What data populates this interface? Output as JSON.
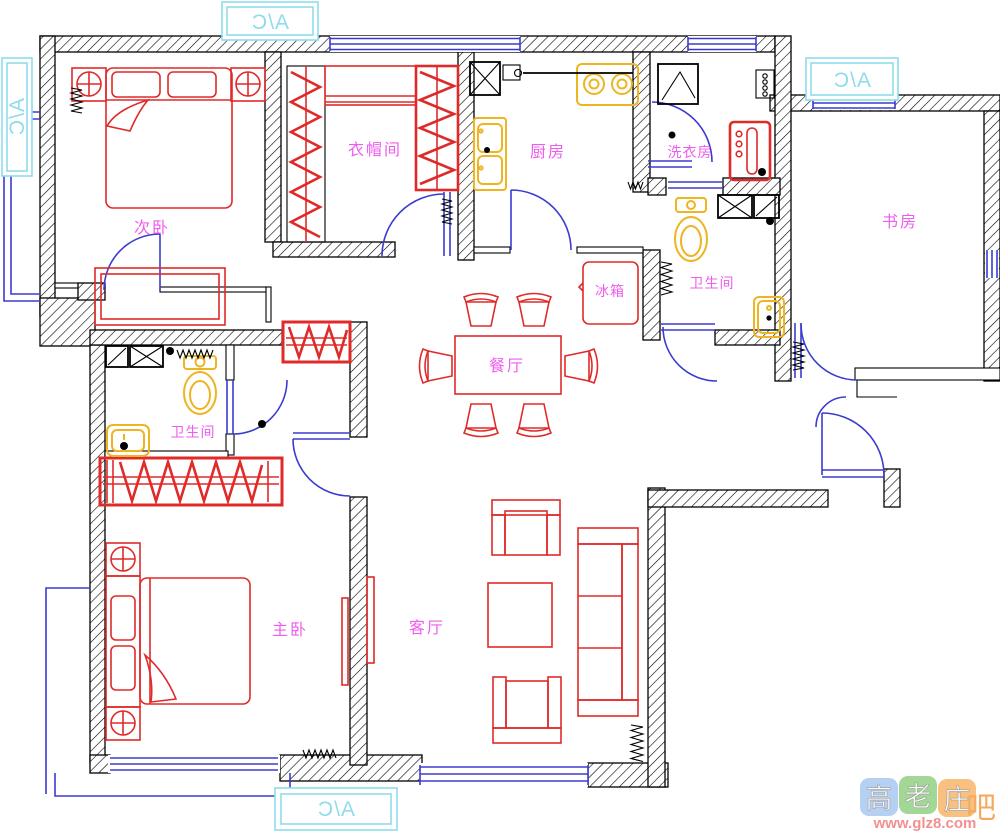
{
  "plan": {
    "rooms": [
      {
        "id": "ciwo",
        "label": "次卧"
      },
      {
        "id": "yimaojian",
        "label": "衣帽间"
      },
      {
        "id": "chufang",
        "label": "厨房"
      },
      {
        "id": "xiyifang",
        "label": "洗衣房"
      },
      {
        "id": "shufang",
        "label": "书房"
      },
      {
        "id": "weishengjian-right",
        "label": "卫生间"
      },
      {
        "id": "bingxiang",
        "label": "冰箱"
      },
      {
        "id": "canting",
        "label": "餐厅"
      },
      {
        "id": "weishengjian-left",
        "label": "卫生间"
      },
      {
        "id": "zhuwo",
        "label": "主卧"
      },
      {
        "id": "keting",
        "label": "客厅"
      }
    ],
    "ac": {
      "top": "A/C",
      "left": "A/C",
      "right": "A/C",
      "bottom": "A/C"
    },
    "colors": {
      "red": "#e02a2a",
      "blue": "#3b3bd2",
      "yellow": "#eeb422",
      "magenta": "#ee5cee",
      "cyan": "#8fdcec"
    }
  },
  "watermark": {
    "chars": [
      "高",
      "老",
      "庄"
    ],
    "suffix": "吧",
    "url": "www.glz8.com",
    "tile_colors": [
      "#a8c8f0",
      "#92d082",
      "#f8b56a"
    ]
  }
}
